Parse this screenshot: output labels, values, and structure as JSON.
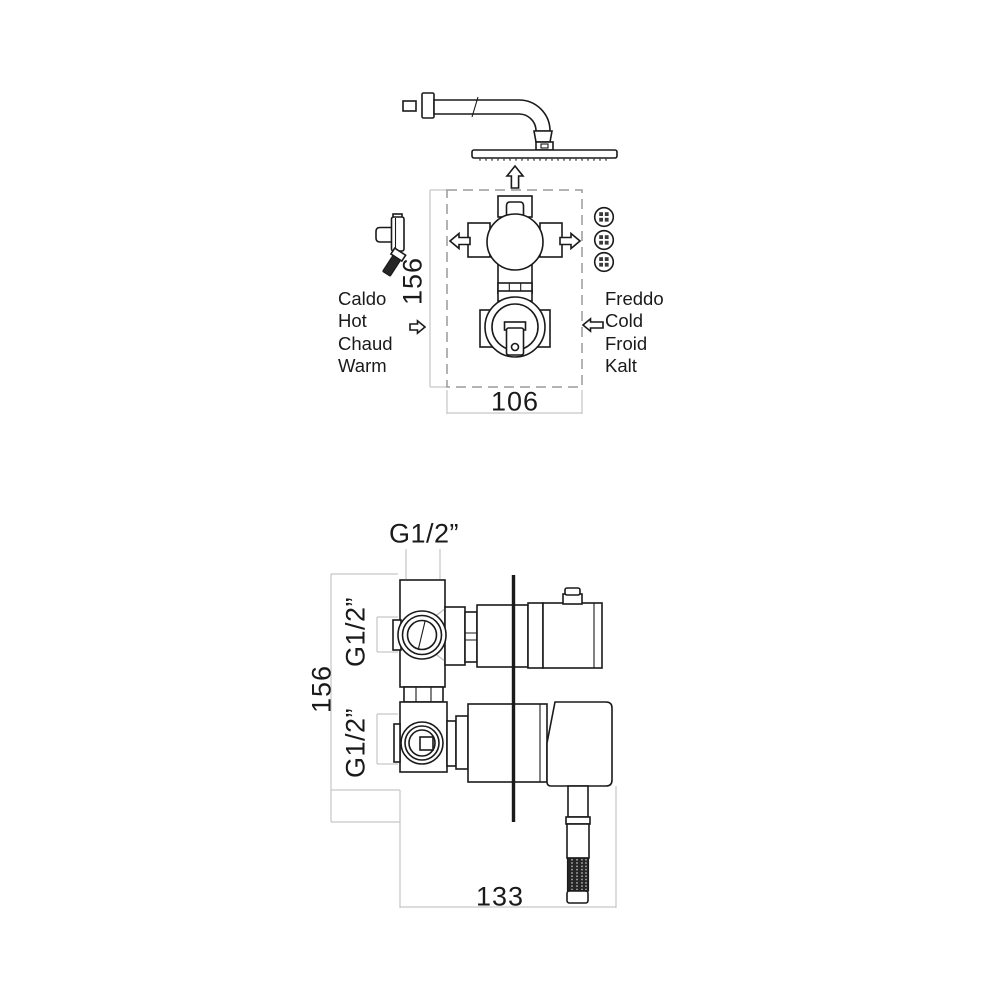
{
  "colors": {
    "line": "#1a1a1a",
    "dimension_line": "#c6c6c6",
    "dashed_box": "#9a9a9a",
    "dark_fill": "#262626"
  },
  "top_view": {
    "hot_labels": [
      "Caldo",
      "Hot",
      "Chaud",
      "Warm"
    ],
    "cold_labels": [
      "Freddo",
      "Cold",
      "Froid",
      "Kalt"
    ],
    "dim_height": "156",
    "dim_width": "106"
  },
  "side_view": {
    "dim_top_port": "G1/2”",
    "dim_upper_port": "G1/2”",
    "dim_lower_port": "G1/2”",
    "dim_height": "156",
    "dim_width": "133"
  }
}
